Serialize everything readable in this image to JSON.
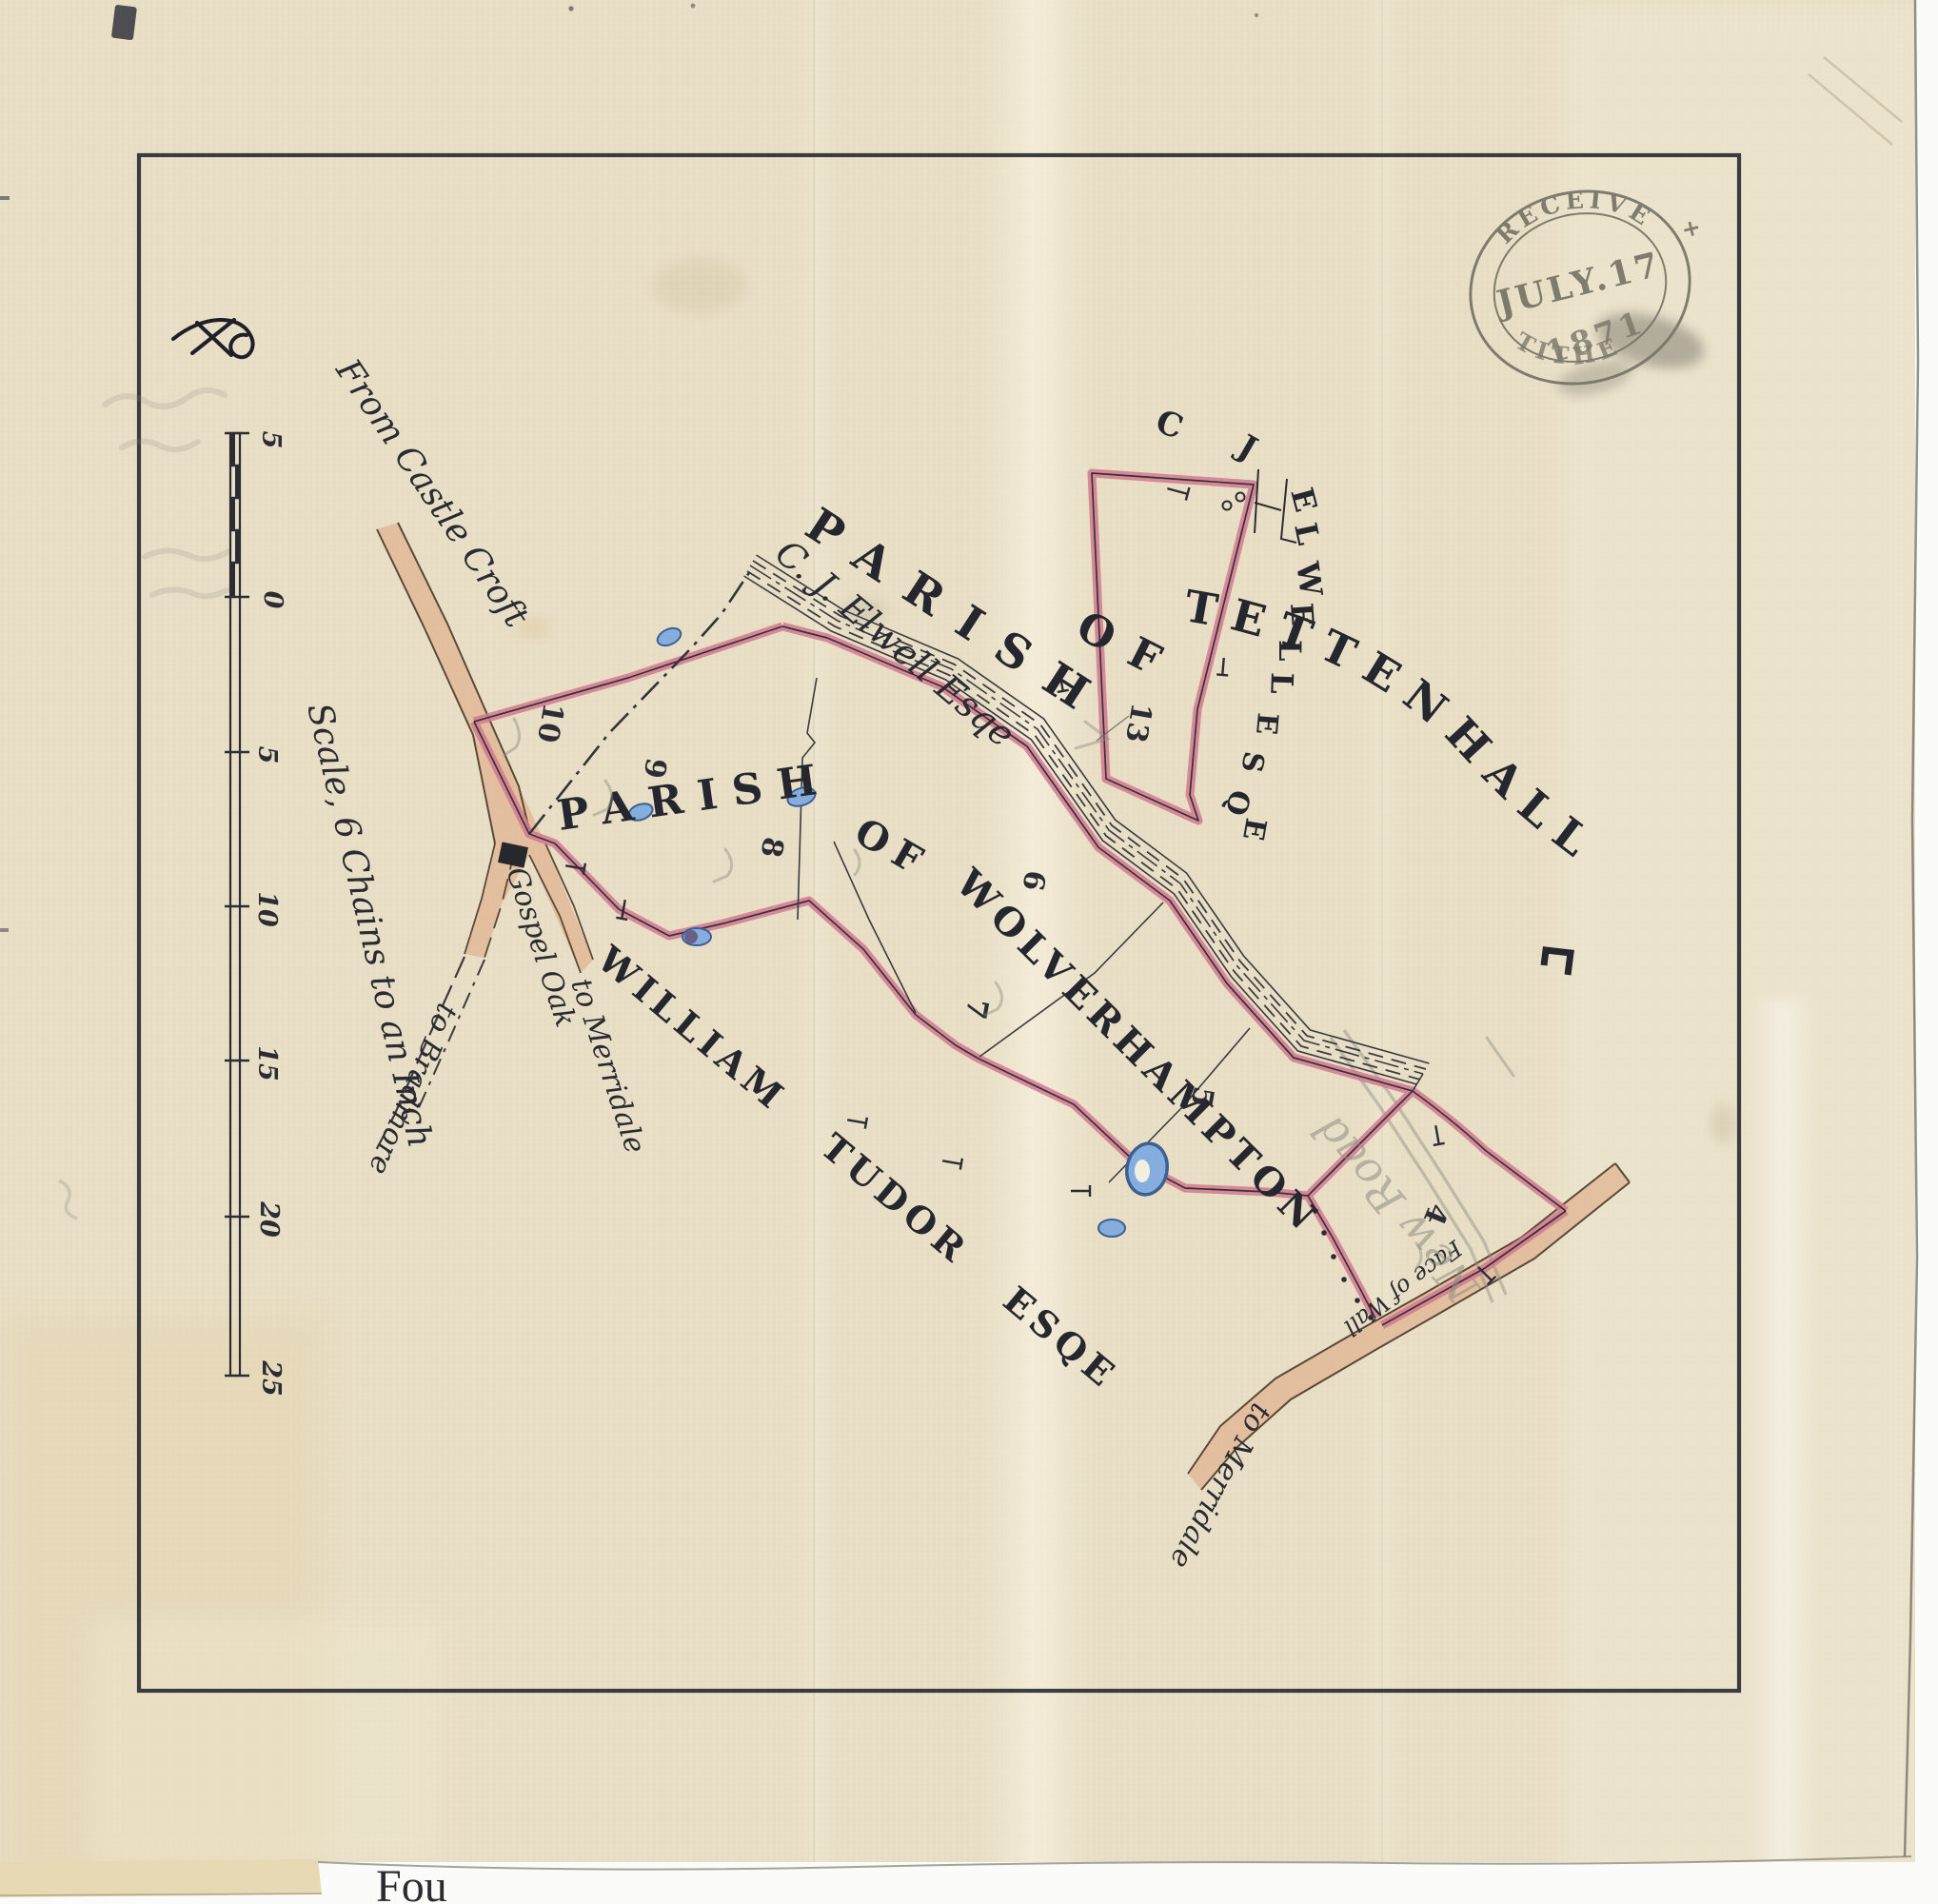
{
  "stamp": {
    "received": "RECEIVED",
    "date": "JULY.17",
    "year": "1871",
    "office": "TITHE",
    "plus": "+"
  },
  "scale": {
    "label": "Scale, 6 Chains to an Inch",
    "ticks": [
      "5",
      "0",
      "5",
      "10",
      "15",
      "20",
      "25"
    ]
  },
  "roads": {
    "from_castle_croft": "From Castle Croft",
    "to_bradmore": "to Bradmore",
    "gospel_oak": "Gospel Oak",
    "to_merridale_left": "to Merridale",
    "to_merridale_bottom": "to Merridale",
    "face_of_wall": "Face of Wall",
    "pencil_road": "New Road"
  },
  "parishes": {
    "tettenhall_word1": "PARISH",
    "tettenhall_word2": "OF",
    "tettenhall_name": "TETTENHALL",
    "wolverhampton_word1": "PARISH",
    "wolverhampton_word2": "OF",
    "wolverhampton_name": "WOLVERHAMPTON"
  },
  "owners": {
    "elwell_script": "C. J. Elwell Esqe",
    "elwell_c": "C",
    "elwell_j": "J",
    "elwell_block": "ELWELL",
    "elwell_esq": "ESQE",
    "tudor": "WILLIAM TUDOR ESQE"
  },
  "plots": [
    {
      "label": "13"
    },
    {
      "label": "10"
    },
    {
      "label": "9"
    },
    {
      "label": "8"
    },
    {
      "label": "6"
    },
    {
      "label": "7"
    },
    {
      "label": "5"
    },
    {
      "label": "4"
    }
  ],
  "page": {
    "bottom_fragment": "Fou"
  },
  "colors": {
    "paper": "#e9dfc6",
    "boundary_pink": "#d4798f",
    "road_tan": "#e0b795",
    "pond_blue": "#85aede",
    "ink": "#2c2c34",
    "stamp_ink": "#56564c",
    "pencil": "#8d8d83"
  }
}
